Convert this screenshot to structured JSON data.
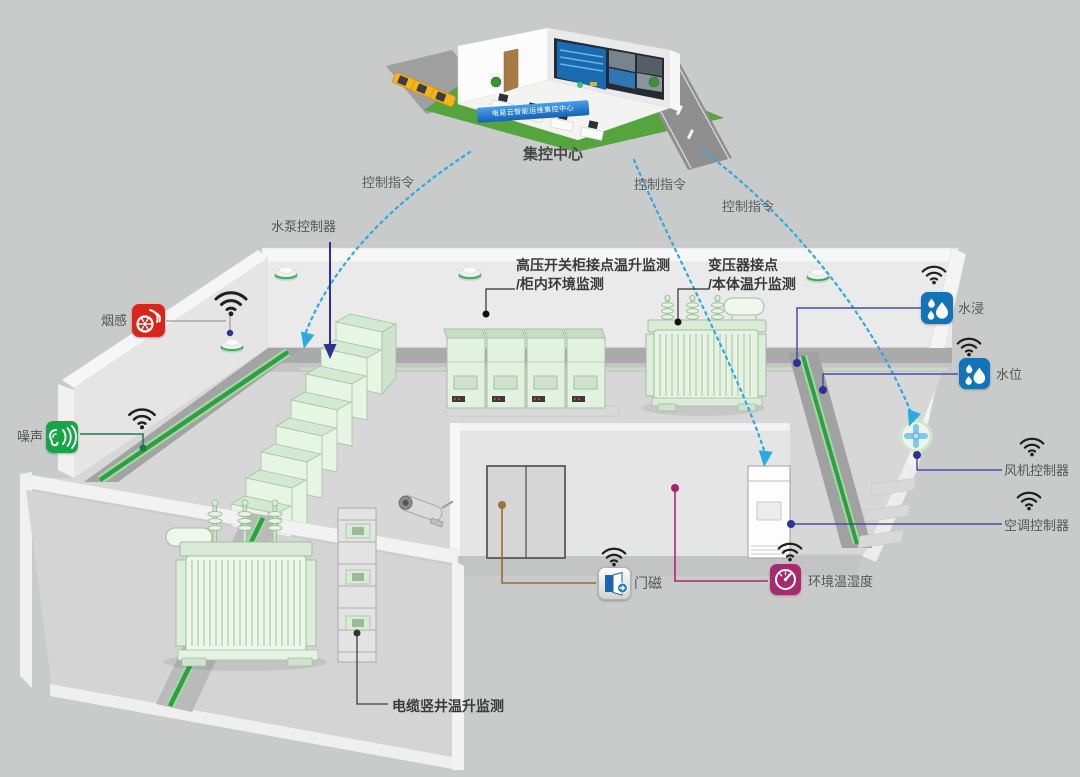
{
  "scene": {
    "background_color": "#c9cbca"
  },
  "control_center": {
    "name_label": "集控中心",
    "banner_text": "电易云智能运维集控中心"
  },
  "command_labels": [
    "控制指令",
    "控制指令",
    "控制指令"
  ],
  "device_labels": {
    "pump_controller": "水泵控制器",
    "smoke": "烟感",
    "noise": "噪声",
    "flood": "水浸",
    "water_level": "水位",
    "fan_controller": "风机控制器",
    "ac_controller": "空调控制器",
    "door_magnet": "门磁",
    "env_temp_humidity": "环境温湿度"
  },
  "monitor_labels": {
    "hv_switchgear_line1": "高压开关柜接点温升监测",
    "hv_switchgear_line2": "/柜内环境监测",
    "transformer_line1": "变压器接点",
    "transformer_line2": "/本体温升监测",
    "cable_shaft": "电缆竖井温升监测"
  },
  "colors": {
    "background": "#c9cbca",
    "command_dash_blue": "#29abe2",
    "control_arrow_navy": "#2e3192",
    "smoke_icon": "#d9251c",
    "noise_icon": "#18a449",
    "water_icon": "#1274b8",
    "env_icon": "#a62a6d",
    "door_line_brown": "#9c6b33",
    "env_line_magenta": "#b0256f",
    "sensor_line_indigo": "#4a4e9e",
    "cable_tray_green": "#2f9e44",
    "wall": "#e9eae9",
    "floor": "#d6d7d6"
  }
}
